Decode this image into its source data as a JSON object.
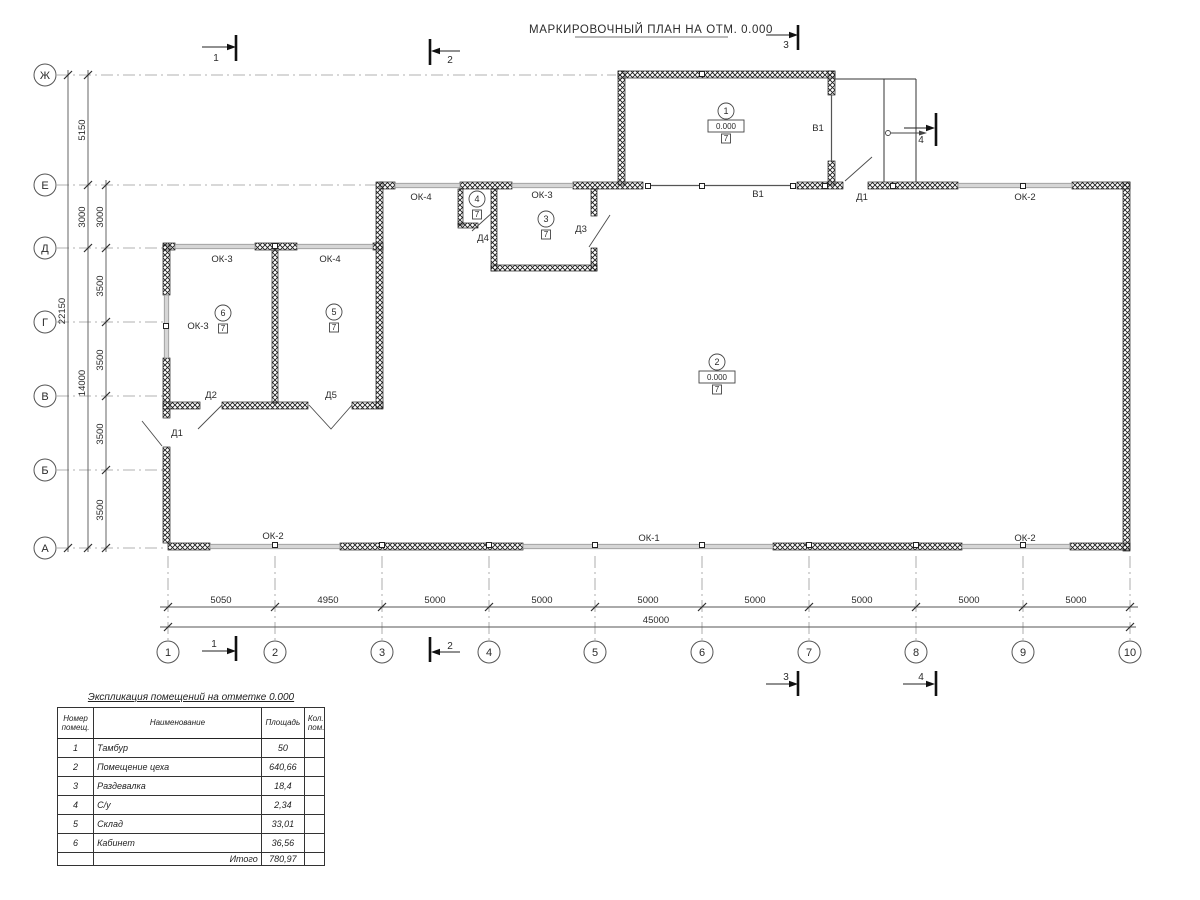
{
  "title": "МАРКИРОВОЧНЫЙ ПЛАН НА ОТМ. 0.000",
  "colors": {
    "wall_hatch": "#1f1f1f",
    "window_fill": "#d6d6d6",
    "axis_line": "#999999"
  },
  "grid": {
    "rows": [
      {
        "label": "Ж",
        "y": 75,
        "ext": 616
      },
      {
        "label": "Е",
        "y": 185,
        "ext": 378
      },
      {
        "label": "Д",
        "y": 248,
        "ext": 163
      },
      {
        "label": "Г",
        "y": 322,
        "ext": 163
      },
      {
        "label": "В",
        "y": 396,
        "ext": 163
      },
      {
        "label": "Б",
        "y": 470,
        "ext": 163
      },
      {
        "label": "А",
        "y": 548,
        "ext": 166
      }
    ],
    "cols": [
      {
        "label": "1",
        "x": 168
      },
      {
        "label": "2",
        "x": 275
      },
      {
        "label": "3",
        "x": 382
      },
      {
        "label": "4",
        "x": 489
      },
      {
        "label": "5",
        "x": 595
      },
      {
        "label": "6",
        "x": 702
      },
      {
        "label": "7",
        "x": 809
      },
      {
        "label": "8",
        "x": 916
      },
      {
        "label": "9",
        "x": 1023
      },
      {
        "label": "10",
        "x": 1130
      }
    ]
  },
  "dims_left": [
    {
      "x": 68,
      "y1": 70,
      "y2": 552,
      "ticks": [
        75,
        548
      ],
      "labels": [
        {
          "t": "22150",
          "y": 311
        }
      ]
    },
    {
      "x": 88,
      "y1": 70,
      "y2": 552,
      "ticks": [
        75,
        185,
        248,
        548
      ],
      "labels": [
        {
          "t": "5150",
          "y": 130
        },
        {
          "t": "3000",
          "y": 217
        },
        {
          "t": "14000",
          "y": 383
        }
      ]
    },
    {
      "x": 106,
      "y1": 180,
      "y2": 552,
      "ticks": [
        185,
        248,
        322,
        396,
        470,
        548
      ],
      "labels": [
        {
          "t": "3000",
          "y": 217
        },
        {
          "t": "3500",
          "y": 286
        },
        {
          "t": "3500",
          "y": 360
        },
        {
          "t": "3500",
          "y": 434
        },
        {
          "t": "3500",
          "y": 510
        }
      ]
    }
  ],
  "dims_bottom": [
    {
      "y": 607,
      "x1": 160,
      "x2": 1138,
      "ticks": [
        168,
        275,
        382,
        489,
        595,
        702,
        809,
        916,
        1023,
        1130
      ],
      "labels": [
        {
          "t": "5050",
          "x": 221
        },
        {
          "t": "4950",
          "x": 328
        },
        {
          "t": "5000",
          "x": 435
        },
        {
          "t": "5000",
          "x": 542
        },
        {
          "t": "5000",
          "x": 648
        },
        {
          "t": "5000",
          "x": 755
        },
        {
          "t": "5000",
          "x": 862
        },
        {
          "t": "5000",
          "x": 969
        },
        {
          "t": "5000",
          "x": 1076
        }
      ]
    },
    {
      "y": 627,
      "x1": 160,
      "x2": 1136,
      "ticks": [
        168,
        1130
      ],
      "labels": [
        {
          "t": "45000",
          "x": 656
        }
      ]
    }
  ],
  "plan_labels": [
    {
      "t": "ОК-3",
      "x": 222,
      "y": 262
    },
    {
      "t": "ОК-4",
      "x": 330,
      "y": 262
    },
    {
      "t": "ОК-3",
      "x": 198,
      "y": 329
    },
    {
      "t": "Д2",
      "x": 211,
      "y": 398
    },
    {
      "t": "Д5",
      "x": 331,
      "y": 398
    },
    {
      "t": "Д1",
      "x": 177,
      "y": 436
    },
    {
      "t": "ОК-4",
      "x": 421,
      "y": 200
    },
    {
      "t": "ОК-3",
      "x": 542,
      "y": 198
    },
    {
      "t": "Д4",
      "x": 483,
      "y": 241
    },
    {
      "t": "Д3",
      "x": 581,
      "y": 232
    },
    {
      "t": "В1",
      "x": 758,
      "y": 197
    },
    {
      "t": "Д1",
      "x": 862,
      "y": 200
    },
    {
      "t": "ОК-2",
      "x": 1025,
      "y": 200
    },
    {
      "t": "В1",
      "x": 818,
      "y": 131
    },
    {
      "t": "ОК-2",
      "x": 273,
      "y": 539
    },
    {
      "t": "ОК-1",
      "x": 649,
      "y": 541
    },
    {
      "t": "ОК-2",
      "x": 1025,
      "y": 541
    }
  ],
  "room_marks": [
    {
      "num": "1",
      "x": 726,
      "y": 111,
      "elev": "0.000",
      "floor": "7"
    },
    {
      "num": "2",
      "x": 717,
      "y": 362,
      "elev": "0.000",
      "floor": "7"
    },
    {
      "num": "3",
      "x": 546,
      "y": 219,
      "floor": "7"
    },
    {
      "num": "4",
      "x": 477,
      "y": 199,
      "floor": "7"
    },
    {
      "num": "5",
      "x": 334,
      "y": 312,
      "floor": "7"
    },
    {
      "num": "6",
      "x": 223,
      "y": 313,
      "floor": "7"
    }
  ],
  "column_squares": [
    {
      "x": 648,
      "y": 186
    },
    {
      "x": 702,
      "y": 186
    },
    {
      "x": 793,
      "y": 186
    },
    {
      "x": 825,
      "y": 186
    },
    {
      "x": 893,
      "y": 186
    },
    {
      "x": 1023,
      "y": 186
    },
    {
      "x": 702,
      "y": 74
    },
    {
      "x": 275,
      "y": 246
    },
    {
      "x": 275,
      "y": 545
    },
    {
      "x": 382,
      "y": 545
    },
    {
      "x": 489,
      "y": 545
    },
    {
      "x": 595,
      "y": 545
    },
    {
      "x": 702,
      "y": 545
    },
    {
      "x": 809,
      "y": 545
    },
    {
      "x": 916,
      "y": 545
    },
    {
      "x": 1023,
      "y": 545
    },
    {
      "x": 166,
      "y": 326
    }
  ],
  "section_marks": [
    {
      "num": "1",
      "line": [
        202,
        47,
        228,
        47
      ],
      "tip": [
        236,
        47
      ],
      "dir": "r",
      "bar": [
        236,
        35,
        61
      ],
      "text": [
        216,
        61
      ]
    },
    {
      "num": "2",
      "line": [
        436,
        51,
        460,
        51
      ],
      "tip": [
        431,
        51
      ],
      "dir": "l",
      "bar": [
        430,
        39,
        65
      ],
      "text": [
        450,
        63
      ]
    },
    {
      "num": "3",
      "line": [
        766,
        35,
        790,
        35
      ],
      "tip": [
        798,
        35
      ],
      "dir": "r",
      "bar": [
        798,
        25,
        50
      ],
      "text": [
        786,
        48
      ]
    },
    {
      "num": "4",
      "line": [
        904,
        128,
        928,
        128
      ],
      "tip": [
        935,
        128
      ],
      "dir": "r",
      "bar": [
        936,
        113,
        146
      ],
      "text": [
        921,
        143
      ]
    },
    {
      "num": "1",
      "line": [
        202,
        651,
        228,
        651
      ],
      "tip": [
        236,
        651
      ],
      "dir": "r",
      "bar": [
        236,
        636,
        661
      ],
      "text": [
        214,
        647
      ]
    },
    {
      "num": "2",
      "line": [
        436,
        652,
        460,
        652
      ],
      "tip": [
        431,
        652
      ],
      "dir": "l",
      "bar": [
        430,
        637,
        662
      ],
      "text": [
        450,
        649
      ]
    },
    {
      "num": "3",
      "line": [
        766,
        684,
        790,
        684
      ],
      "tip": [
        798,
        684
      ],
      "dir": "r",
      "bar": [
        798,
        671,
        696
      ],
      "text": [
        786,
        680
      ]
    },
    {
      "num": "4",
      "line": [
        903,
        684,
        927,
        684
      ],
      "tip": [
        935,
        684
      ],
      "dir": "r",
      "bar": [
        936,
        671,
        696
      ],
      "text": [
        921,
        680
      ]
    }
  ],
  "table": {
    "title": "Экспликация помещений на отметке 0.000",
    "headers": {
      "num": "Номер\nпомещ.",
      "name": "Наименование",
      "area": "Площадь",
      "count": "Кол.\nпом."
    },
    "rows": [
      [
        "1",
        "Тамбур",
        "50"
      ],
      [
        "2",
        "Помещение цеха",
        "640,66"
      ],
      [
        "3",
        "Раздевалка",
        "18,4"
      ],
      [
        "4",
        "С/у",
        "2,34"
      ],
      [
        "5",
        "Склад",
        "33,01"
      ],
      [
        "6",
        "Кабинет",
        "36,56"
      ]
    ],
    "total_label": "Итого",
    "total_value": "780,97"
  }
}
